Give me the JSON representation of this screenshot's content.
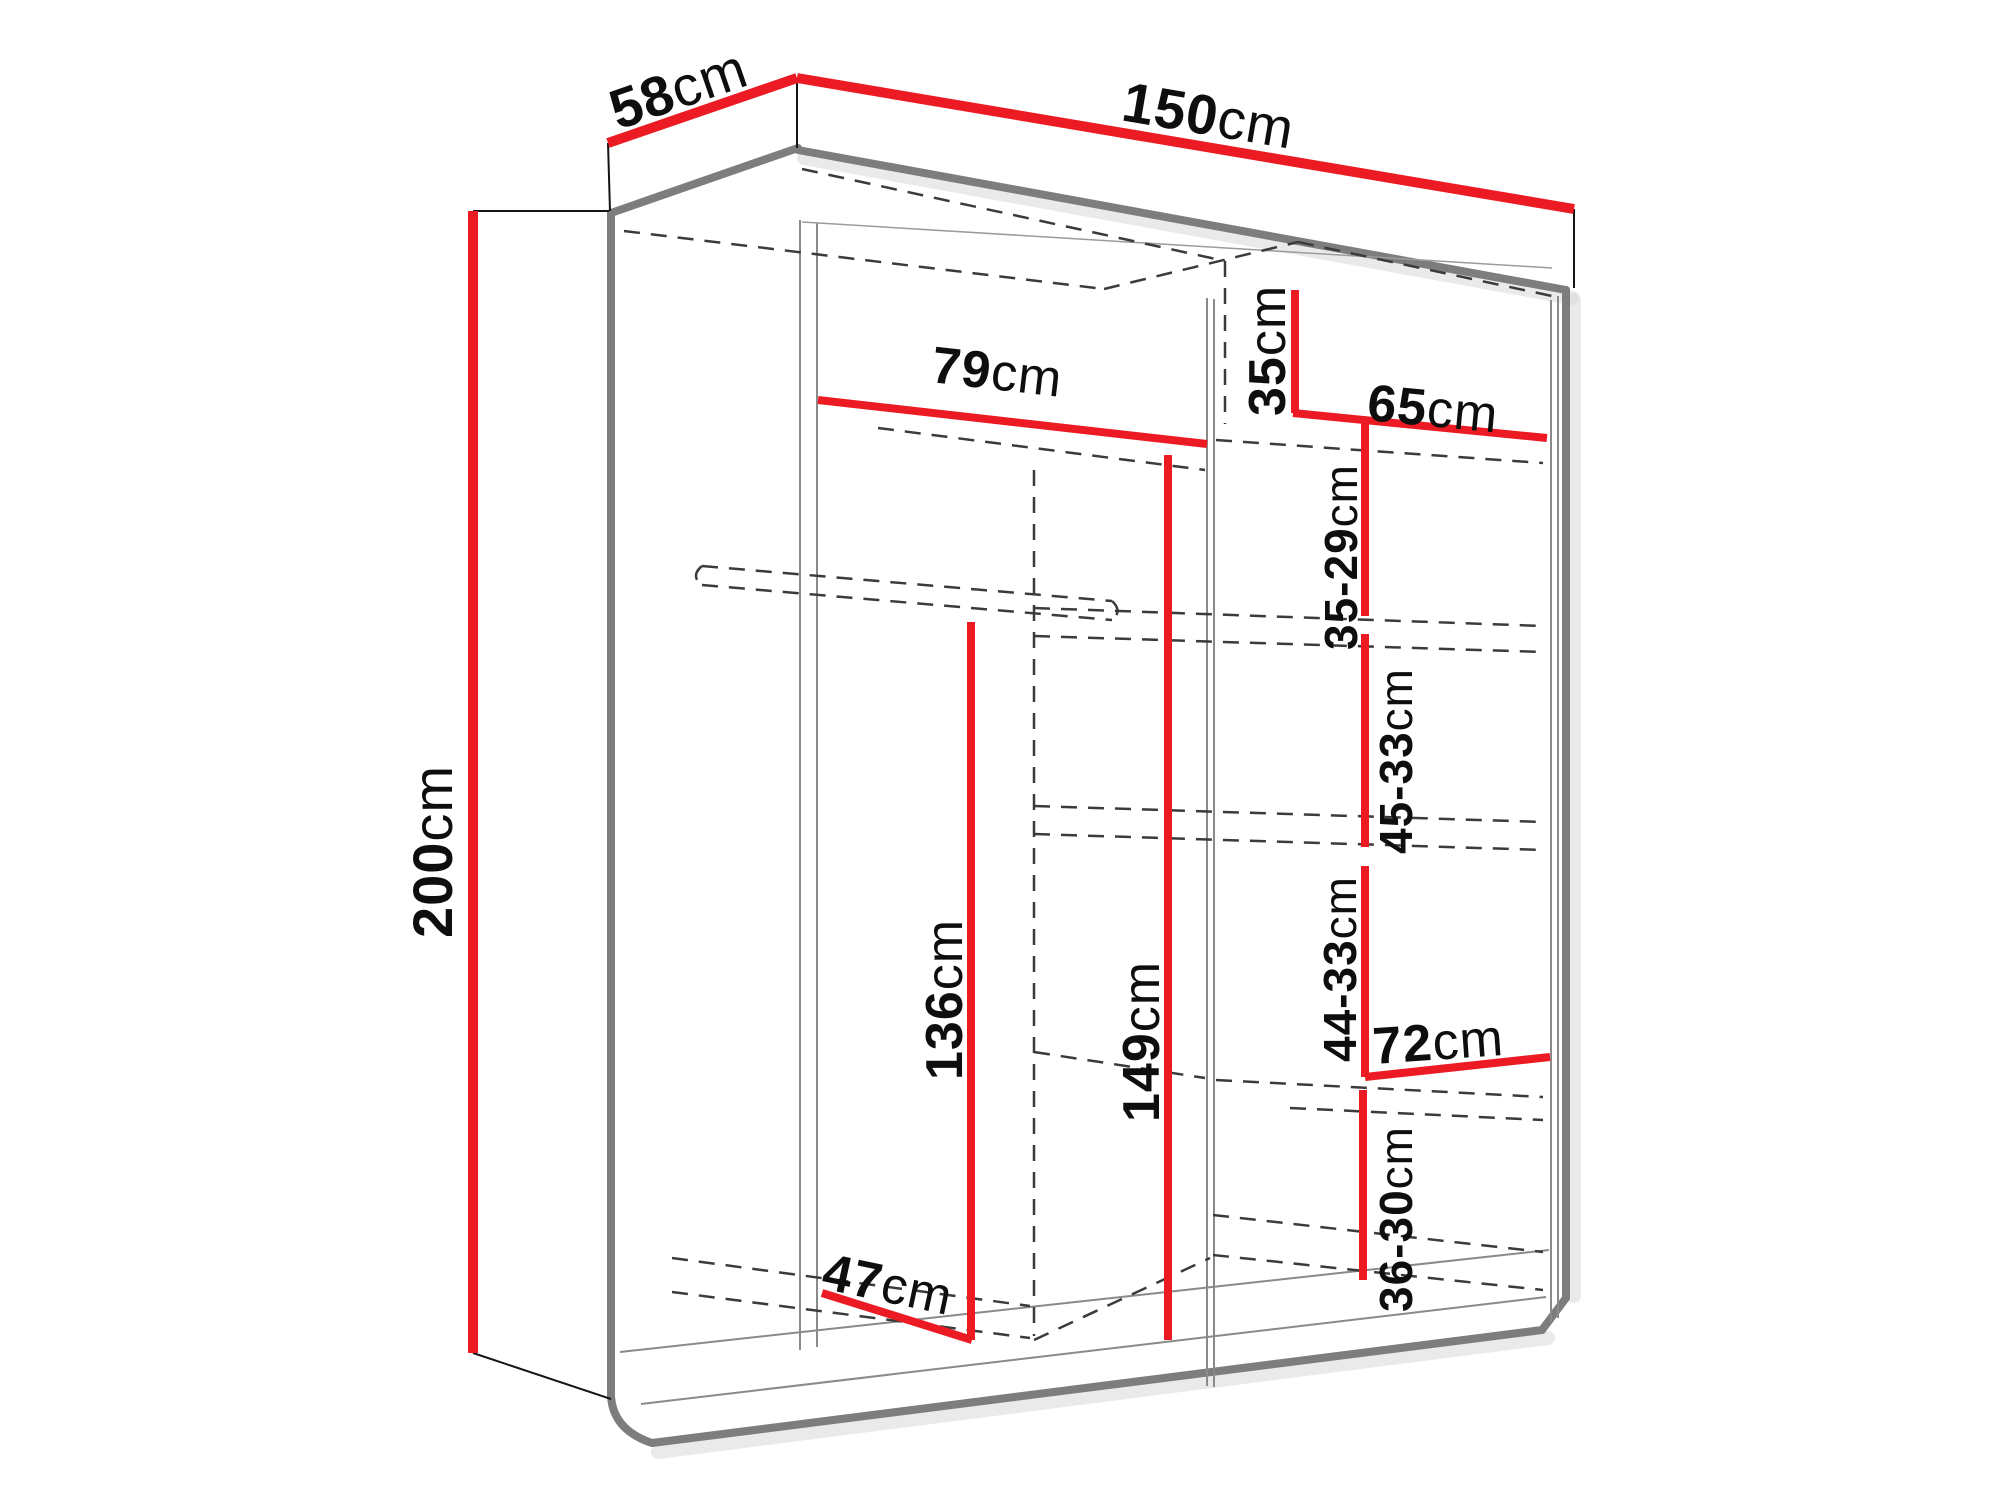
{
  "colors": {
    "dimension_line_red": "#EC1B23",
    "panel_edge_gray": "#7D7D7D",
    "hidden_edge_dash_gray": "#3B3B3B",
    "label_black": "#0E0E0E",
    "background": "#FFFFFF"
  },
  "dimensions": {
    "depth": {
      "value": "58",
      "unit": "cm"
    },
    "width": {
      "value": "150",
      "unit": "cm"
    },
    "height": {
      "value": "200",
      "unit": "cm"
    },
    "left_top_shelf_width": {
      "value": "79",
      "unit": "cm"
    },
    "right_top_gap": {
      "value": "35",
      "unit": "cm"
    },
    "right_shelf_width": {
      "value": "65",
      "unit": "cm"
    },
    "right_gap_1": {
      "value": "35-29",
      "unit": "cm"
    },
    "right_gap_2": {
      "value": "45-33",
      "unit": "cm"
    },
    "hanging_height_left": {
      "value": "136",
      "unit": "cm"
    },
    "hanging_height_center": {
      "value": "149",
      "unit": "cm"
    },
    "right_gap_3": {
      "value": "44-33",
      "unit": "cm"
    },
    "bottom_shelf_width": {
      "value": "72",
      "unit": "cm"
    },
    "right_gap_4": {
      "value": "36-30",
      "unit": "cm"
    },
    "floor_depth": {
      "value": "47",
      "unit": "cm"
    }
  }
}
